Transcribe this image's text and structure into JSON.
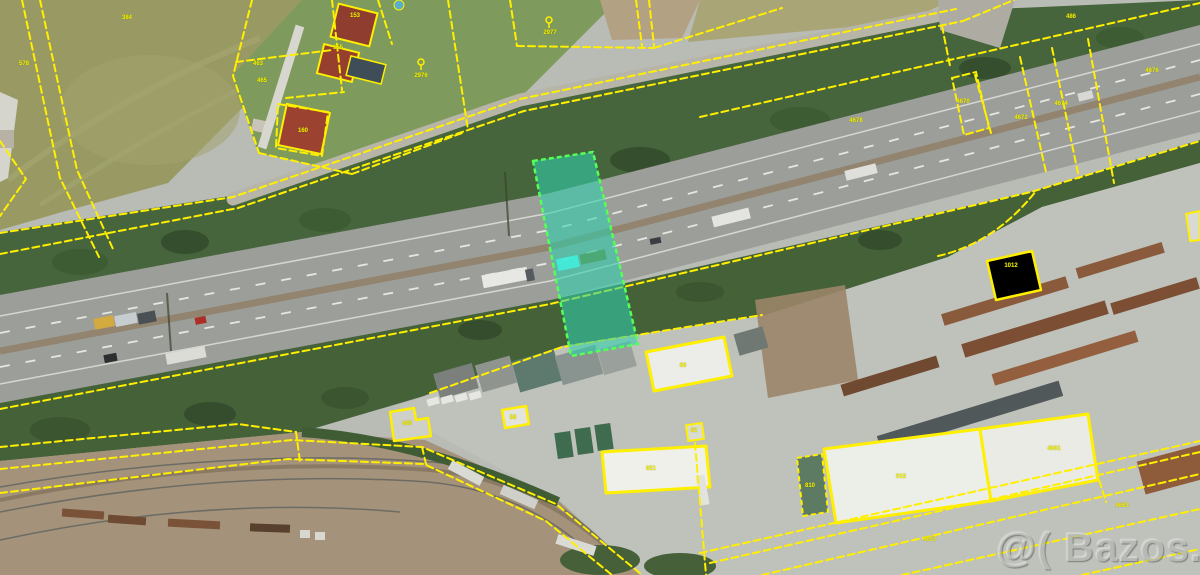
{
  "watermark": {
    "text": "@( Bazos.cz"
  },
  "map": {
    "kind": "aerial-photo-with-cadastral-overlay",
    "cadastral_line_color": "#ffef00",
    "highlight": {
      "name": "highlighted-parcel",
      "fill_color": "#2ed1ad",
      "border_color": "#55ff58"
    },
    "labels": [
      {
        "text": "384",
        "x": 127,
        "y": 18
      },
      {
        "text": "578",
        "x": 24,
        "y": 64
      },
      {
        "text": "463",
        "x": 258,
        "y": 64
      },
      {
        "text": "465",
        "x": 262,
        "y": 81
      },
      {
        "text": "153",
        "x": 355,
        "y": 16
      },
      {
        "text": "155",
        "x": 338,
        "y": 48
      },
      {
        "text": "160",
        "x": 303,
        "y": 131
      },
      {
        "text": "2977",
        "x": 550,
        "y": 33
      },
      {
        "text": "2976",
        "x": 421,
        "y": 76
      },
      {
        "text": "486",
        "x": 1071,
        "y": 17
      },
      {
        "text": "4676",
        "x": 1152,
        "y": 71
      },
      {
        "text": "4674",
        "x": 1061,
        "y": 104
      },
      {
        "text": "4672",
        "x": 1021,
        "y": 118
      },
      {
        "text": "4670",
        "x": 963,
        "y": 102
      },
      {
        "text": "4678",
        "x": 856,
        "y": 121
      },
      {
        "text": "60",
        "x": 683,
        "y": 366
      },
      {
        "text": "62",
        "x": 694,
        "y": 431
      },
      {
        "text": "58",
        "x": 513,
        "y": 418
      },
      {
        "text": "409",
        "x": 407,
        "y": 424
      },
      {
        "text": "651",
        "x": 651,
        "y": 469
      },
      {
        "text": "915",
        "x": 901,
        "y": 477
      },
      {
        "text": "1012",
        "x": 1011,
        "y": 266
      },
      {
        "text": "810",
        "x": 810,
        "y": 486
      },
      {
        "text": "4661",
        "x": 1054,
        "y": 449
      },
      {
        "text": "4663",
        "x": 1122,
        "y": 506
      },
      {
        "text": "4657",
        "x": 930,
        "y": 540
      }
    ]
  }
}
